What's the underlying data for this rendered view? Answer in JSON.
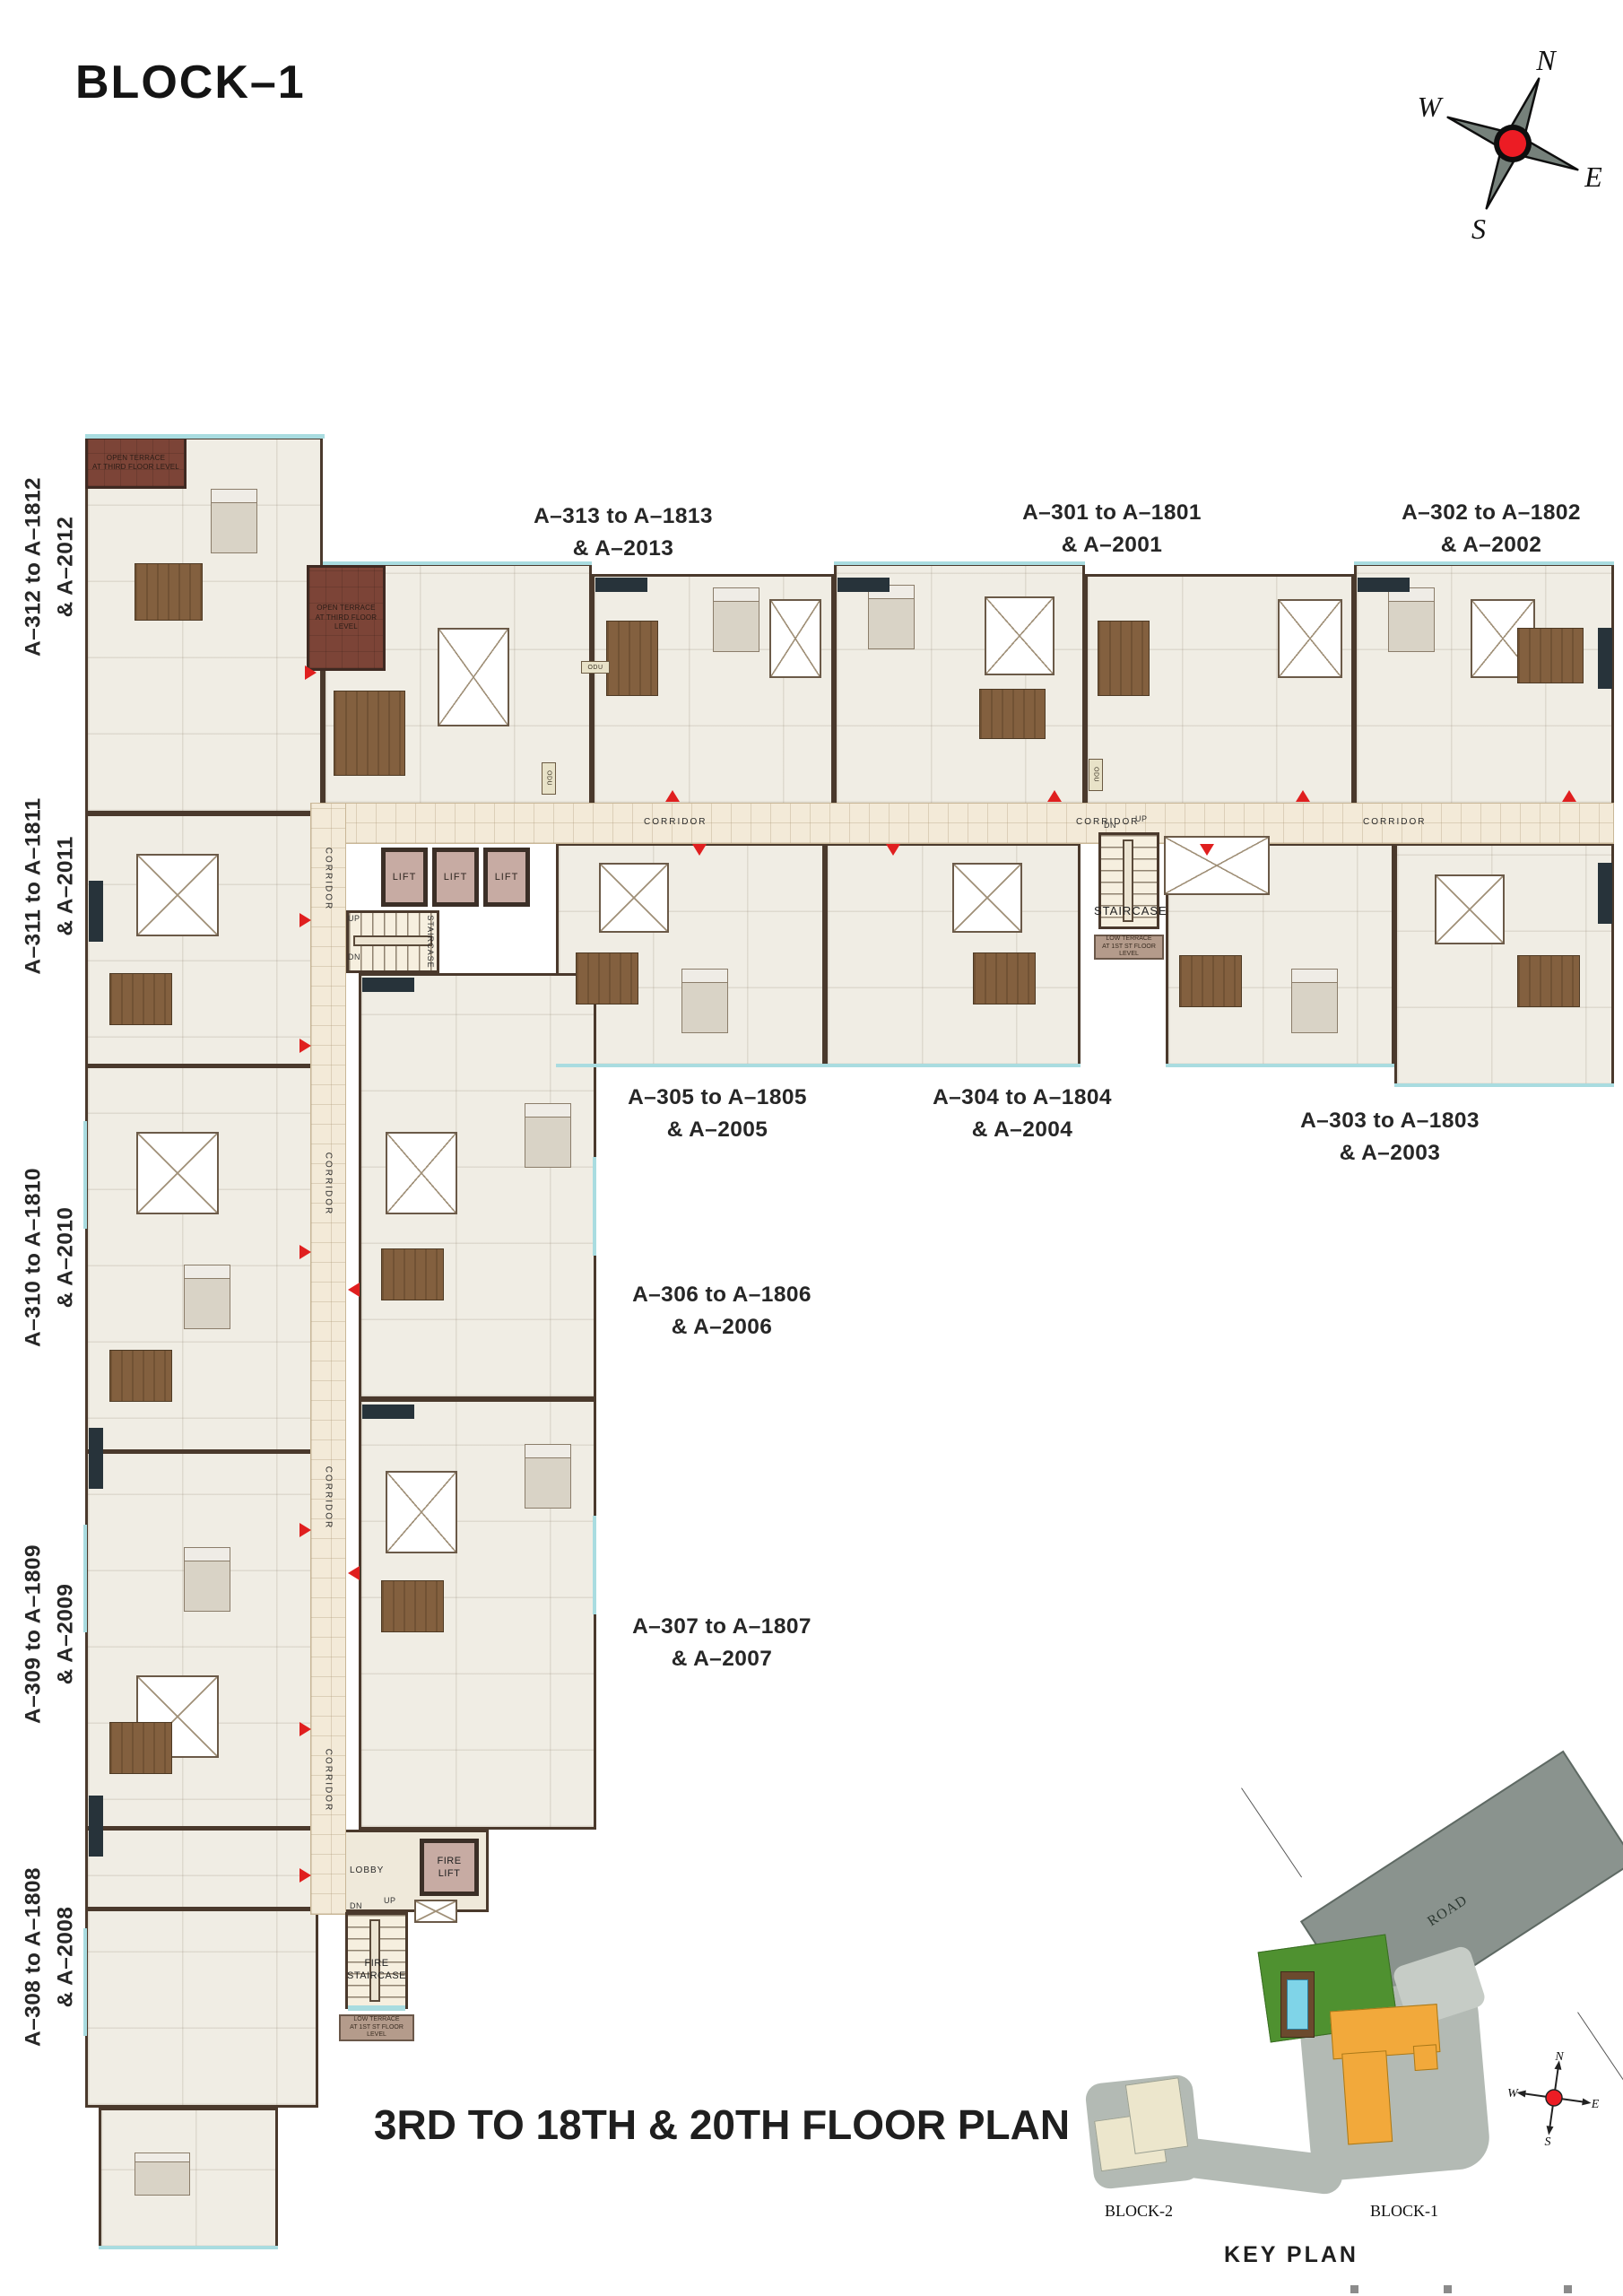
{
  "header": {
    "title": "BLOCK–1"
  },
  "compass": {
    "n": "N",
    "e": "E",
    "s": "S",
    "w": "W"
  },
  "units": {
    "a313": {
      "l1": "A–313 to A–1813",
      "l2": "& A–2013"
    },
    "a301": {
      "l1": "A–301 to A–1801",
      "l2": "& A–2001"
    },
    "a302": {
      "l1": "A–302 to A–1802",
      "l2": "& A–2002"
    },
    "a305": {
      "l1": "A–305 to A–1805",
      "l2": "& A–2005"
    },
    "a304": {
      "l1": "A–304 to A–1804",
      "l2": "& A–2004"
    },
    "a303": {
      "l1": "A–303 to A–1803",
      "l2": "& A–2003"
    },
    "a306": {
      "l1": "A–306 to A–1806",
      "l2": "& A–2006"
    },
    "a307": {
      "l1": "A–307 to A–1807",
      "l2": "& A–2007"
    },
    "a312": {
      "l1": "A–312 to A–1812",
      "l2": "& A–2012"
    },
    "a311": {
      "l1": "A–311 to A–1811",
      "l2": "& A–2011"
    },
    "a310": {
      "l1": "A–310 to A–1810",
      "l2": "& A–2010"
    },
    "a309": {
      "l1": "A–309 to A–1809",
      "l2": "& A–2009"
    },
    "a308": {
      "l1": "A–308 to A–1808",
      "l2": "& A–2008"
    }
  },
  "plan": {
    "corridor": "CORRIDOR",
    "lift": "LIFT",
    "staircase": "STAIRCASE",
    "fire_lift_l1": "FIRE",
    "fire_lift_l2": "LIFT",
    "fire_stair_l1": "FIRE",
    "fire_stair_l2": "STAIRCASE",
    "lobby": "LOBBY",
    "up": "UP",
    "dn": "DN",
    "odu": "ODU",
    "open_terrace_l1": "OPEN TERRACE",
    "open_terrace_l2": "AT THIRD FLOOR LEVEL",
    "low_terrace_l1": "LOW TERRACE",
    "low_terrace_l2": "AT 1ST ST FLOOR LEVEL"
  },
  "footer": {
    "floor_title": "3RD TO 18TH & 20TH FLOOR PLAN"
  },
  "key_plan": {
    "title": "KEY PLAN",
    "road": "ROAD",
    "block1": "BLOCK-1",
    "block2": "BLOCK-2",
    "n": "N",
    "e": "E",
    "s": "S",
    "w": "W"
  },
  "colors": {
    "accent_red": "#e01f1f",
    "wall_brown": "#4a392c",
    "corridor_cream": "#f3ead8",
    "lift_mauve": "#c7aba3",
    "terrace_brown": "#7c4437",
    "window_teal": "#a9dce0",
    "road_gray": "#8a938e",
    "block1_orange": "#f2a93b",
    "block2_cream": "#ece6cc",
    "lawn_green": "#4f9130",
    "pool_blue": "#7fd4e8"
  }
}
